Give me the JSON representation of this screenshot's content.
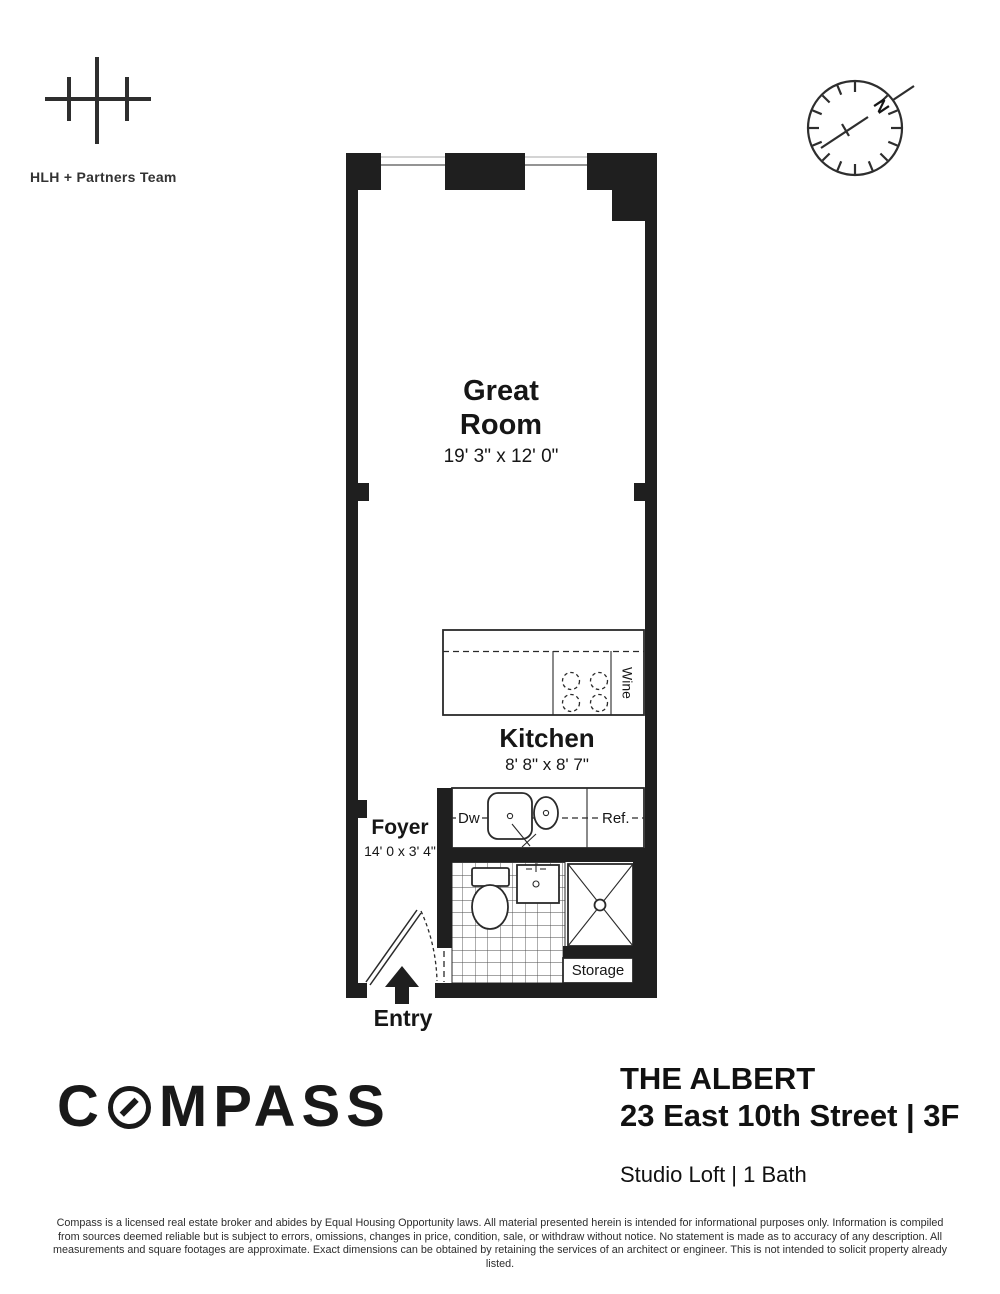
{
  "colors": {
    "wall": "#1f1f1f",
    "ink": "#1a1a1a"
  },
  "header": {
    "team_name": "HLH + Partners Team",
    "north_label": "N"
  },
  "floorplan": {
    "great_room": {
      "name_line1": "Great",
      "name_line2": "Room",
      "dims": "19' 3\" x 12' 0\""
    },
    "kitchen": {
      "name": "Kitchen",
      "dims": "8' 8\" x 8' 7\""
    },
    "foyer": {
      "name": "Foyer",
      "dims": "14' 0 x 3' 4\""
    },
    "entry_label": "Entry",
    "storage_label": "Storage",
    "wine_label": "Wine",
    "dishwasher_label": "Dw",
    "refrigerator_label": "Ref."
  },
  "footer": {
    "logo_pre": "C",
    "logo_post": "MPASS",
    "building_name": "THE ALBERT",
    "address": "23 East 10th Street | 3F",
    "unit_info": "Studio Loft | 1 Bath",
    "disclaimer": [
      "Compass is a licensed real estate broker and abides by Equal Housing Opportunity laws. All material presented herein is intended for informational purposes only. Information is compiled",
      "from sources deemed reliable but is subject to errors, omissions, changes in price, condition, sale, or withdraw without notice. No statement is made as to accuracy of any description. All",
      "measurements and square footages are approximate. Exact dimensions can be obtained by retaining the services of an architect or engineer. This is not intended to solicit property already listed."
    ]
  }
}
